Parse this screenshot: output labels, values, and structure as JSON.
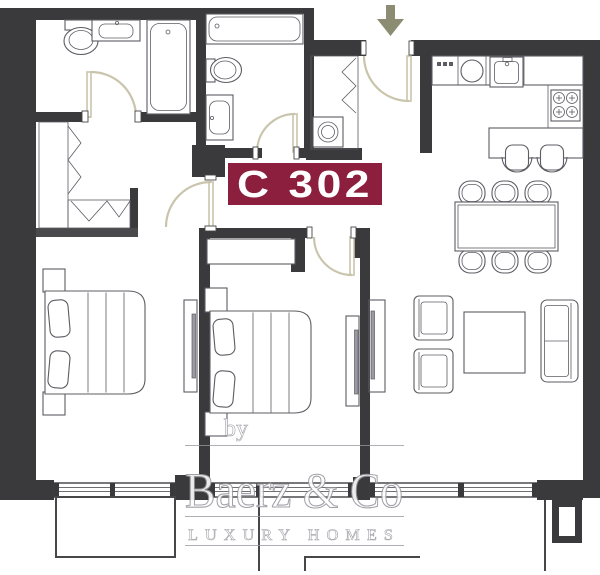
{
  "type": "apartment-floor-plan",
  "unit_badge": {
    "label": "C 302"
  },
  "entrance_arrow": {
    "icon": "down-arrow-icon",
    "meaning": "entrance"
  },
  "watermark": {
    "prefix": "by",
    "brand": "Baerz & Co",
    "tagline": "LUXURY HOMES"
  },
  "colors": {
    "wall_color": "#3A3A3C",
    "wall2_color": "#4A4A4D",
    "fixture_color": "#5C5C63",
    "door_color": "#C9C5AC",
    "balcony_color": "#47474A",
    "arrow_color": "#8C8C72",
    "badge_bg": "#8C1F3E",
    "badge_text": "#FFFFFF",
    "wm_fill": "#FFFFFF",
    "wm_outline": "#97979F"
  }
}
